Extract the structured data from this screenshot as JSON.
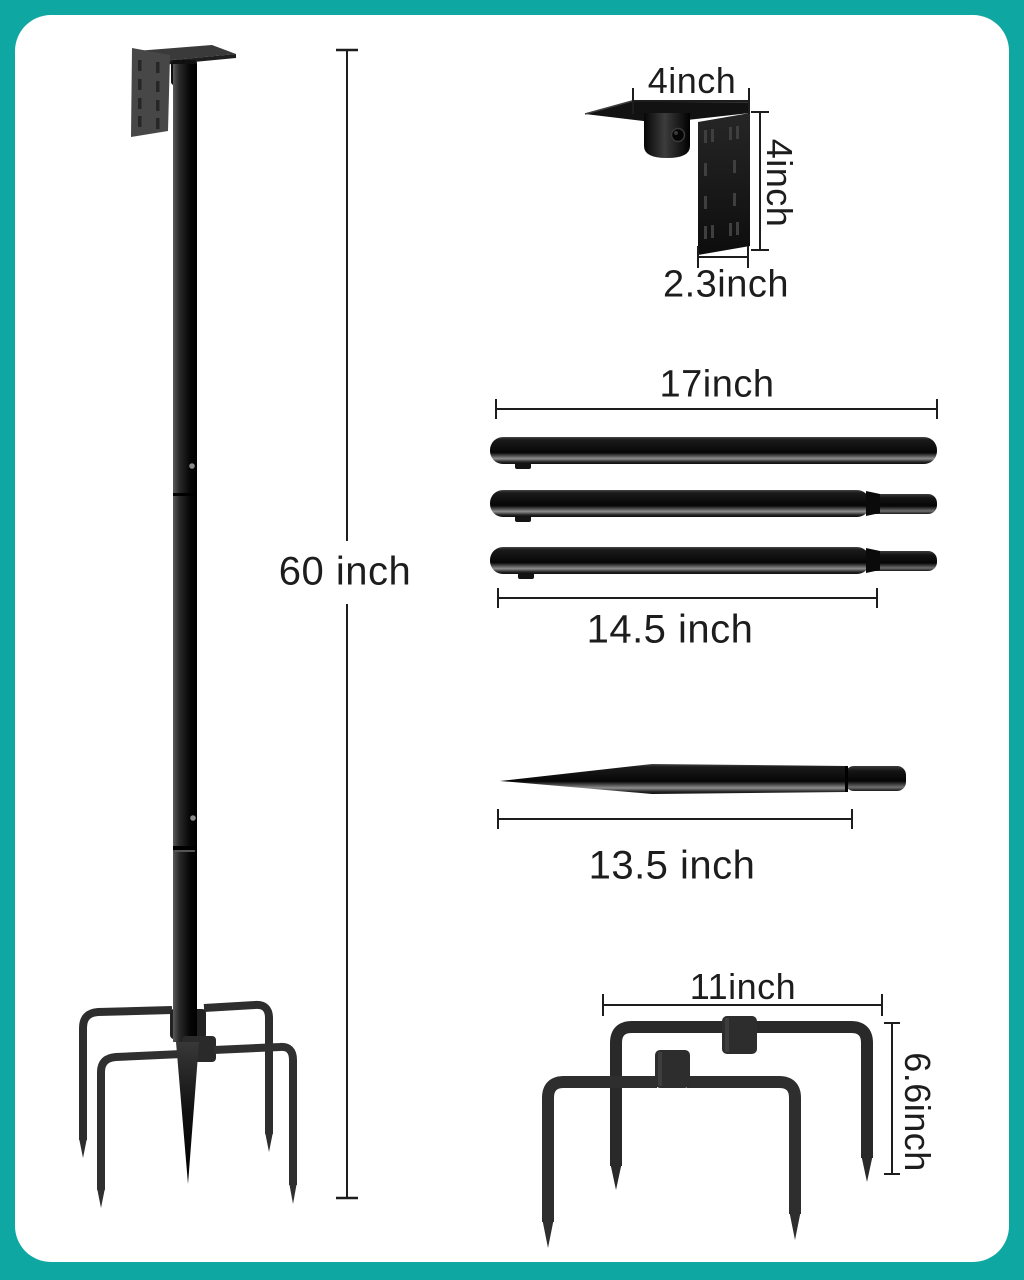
{
  "colors": {
    "frame": "#0fa7a2",
    "panel": "#ffffff",
    "ink": "#1d1d1d",
    "metal_dark": "#161616",
    "metal_mid": "#2d2d2d",
    "plate_gray": "#474747"
  },
  "dimensions": {
    "pole_height": "60 inch",
    "bracket_top_width": "4inch",
    "bracket_side_height": "4inch",
    "bracket_plate_width": "2.3inch",
    "tube_full_length": "17inch",
    "tube_body_length": "14.5 inch",
    "spike_length": "13.5 inch",
    "base_span": "11inch",
    "base_stake_height": "6.6inch"
  }
}
